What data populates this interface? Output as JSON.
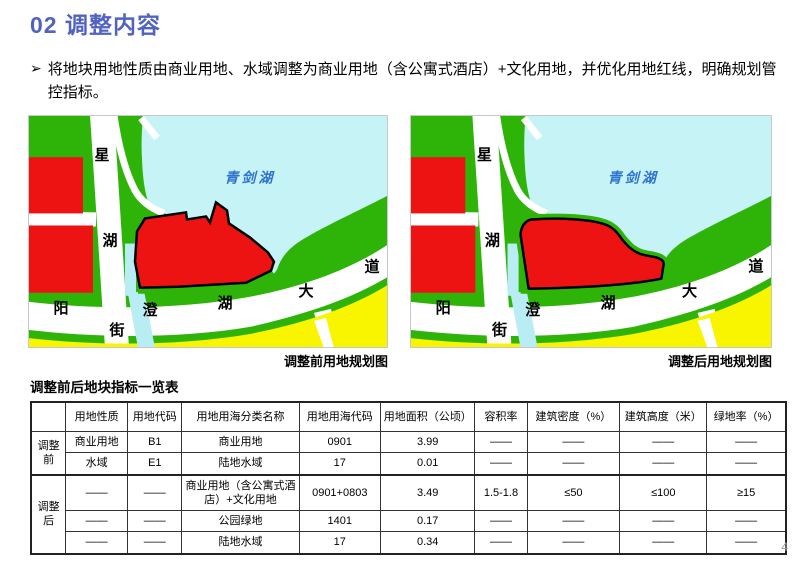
{
  "header": {
    "title": "02 调整内容",
    "bullet_marker": "➢",
    "bullet": "将地块用地性质由商业用地、水域调整为商业用地（含公寓式酒店）+文化用地，并优化用地红线，明确规划管控指标。",
    "accent_blue": "#5163c1"
  },
  "maps": {
    "left": {
      "caption": "调整前用地规划图",
      "lake_label": "青剑湖"
    },
    "right": {
      "caption": "调整后用地规划图",
      "lake_label": "青剑湖"
    },
    "road_labels": {
      "vertical_street": [
        "星",
        "湖",
        "街"
      ],
      "horizontal_avenue": [
        "阳",
        "澄",
        "湖",
        "大",
        "道"
      ]
    },
    "colors": {
      "land_green": "#2eb408",
      "lake_blue": "#c5f3f6",
      "canal_blue": "#b8edf3",
      "parcel_red": "#ee1313",
      "block_yellow": "#f9f400",
      "road_white": "#ffffff",
      "outline_black": "#000000",
      "lake_label_blue": "#2f72cf",
      "map_border": "#c8c8c8"
    }
  },
  "table": {
    "title": "调整前后地块指标一览表",
    "headers": [
      "",
      "用地性质",
      "用地代码",
      "用地用海分类名称",
      "用地用海代码",
      "用地面积（公顷）",
      "容积率",
      "建筑密度（%）",
      "建筑高度（米）",
      "绿地率（%）"
    ],
    "row_groups": [
      {
        "label": "调整前",
        "rows": [
          [
            "商业用地",
            "B1",
            "商业用地",
            "0901",
            "3.99",
            "——",
            "——",
            "——",
            "——"
          ],
          [
            "水域",
            "E1",
            "陆地水域",
            "17",
            "0.01",
            "——",
            "——",
            "——",
            "——"
          ]
        ]
      },
      {
        "label": "调整后",
        "rows": [
          [
            "——",
            "——",
            "商业用地（含公寓式酒店）+文化用地",
            "0901+0803",
            "3.49",
            "1.5-1.8",
            "≤50",
            "≤100",
            "≥15"
          ],
          [
            "——",
            "——",
            "公园绿地",
            "1401",
            "0.17",
            "——",
            "——",
            "——",
            "——"
          ],
          [
            "——",
            "——",
            "陆地水域",
            "17",
            "0.34",
            "——",
            "——",
            "——",
            "——"
          ]
        ]
      }
    ]
  },
  "footer": {
    "page_number": "4"
  }
}
